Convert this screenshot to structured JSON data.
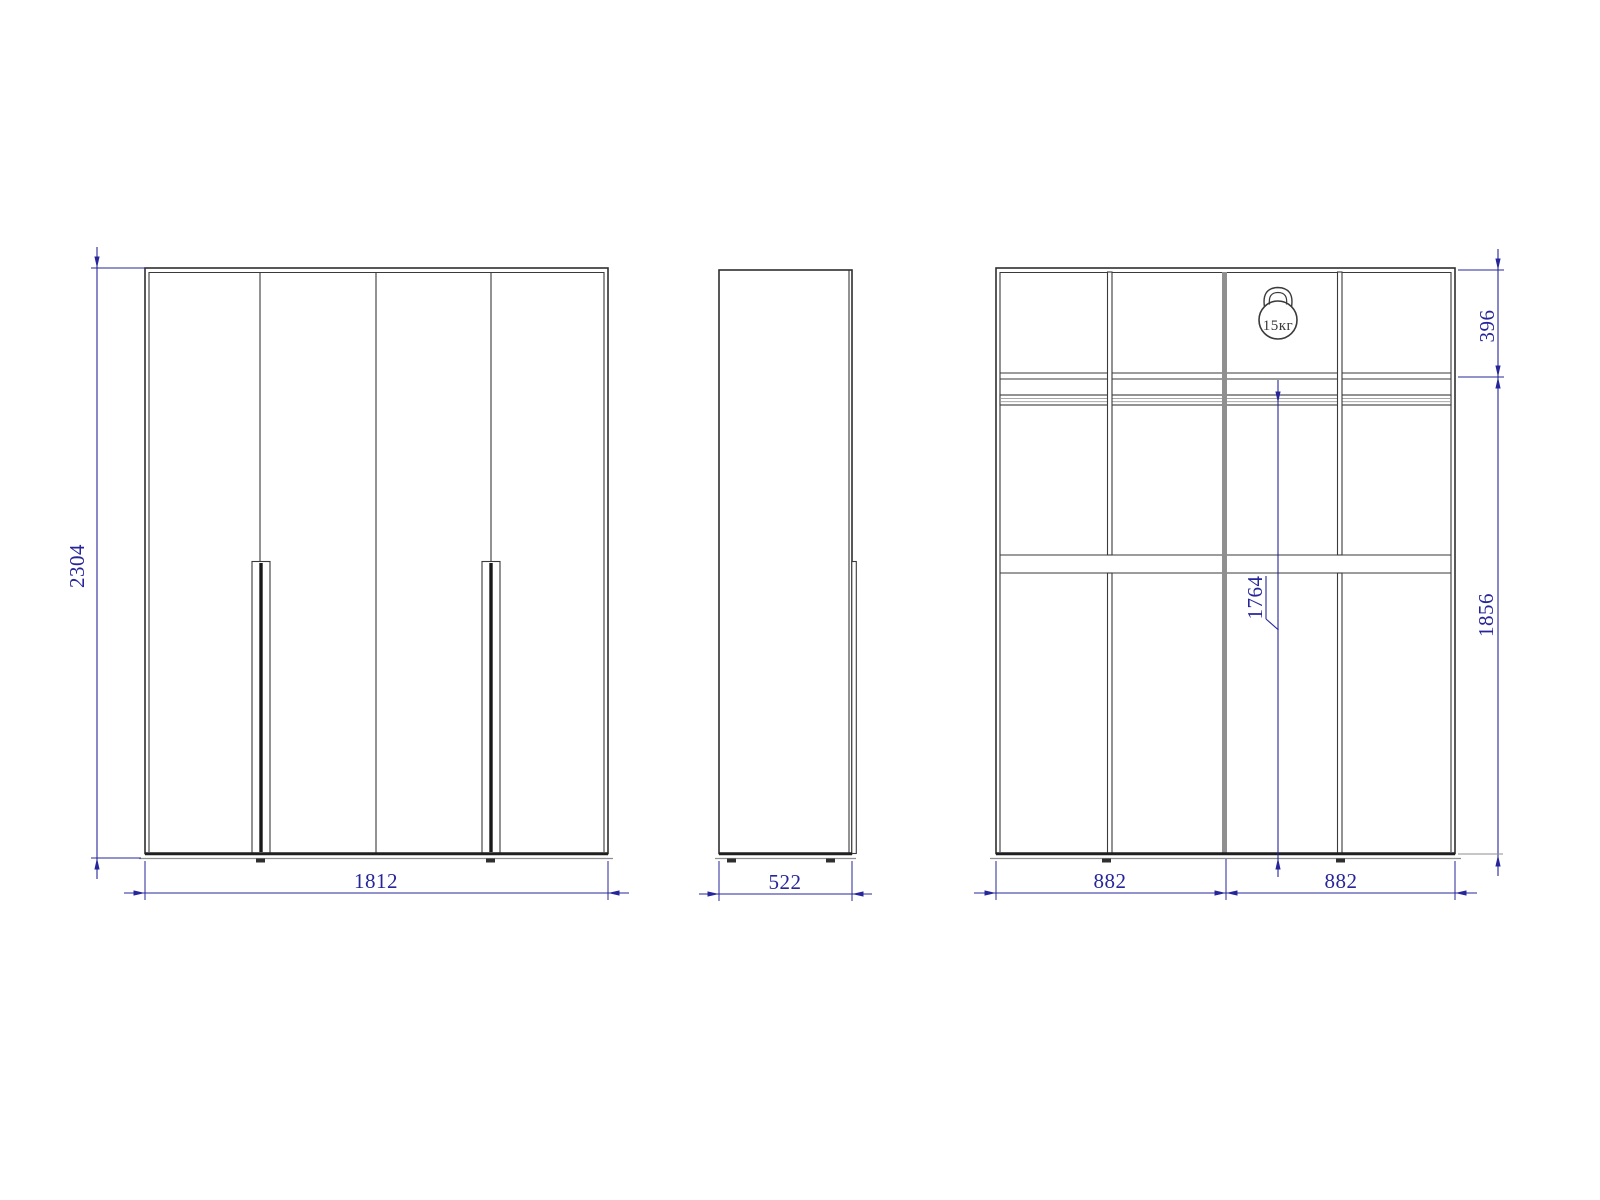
{
  "drawing": {
    "type": "furniture technical drawing, wardrobe, three orthographic views",
    "views": {
      "front": {
        "label": "front-view",
        "doors": 4,
        "handles": 2
      },
      "side": {
        "label": "side-view"
      },
      "internal": {
        "label": "internal-structure-view",
        "sections": 2,
        "shelves": 3,
        "hanging_rod": true
      }
    },
    "dims": {
      "height": "2304",
      "width": "1812",
      "depth": "522",
      "top_section_height": "396",
      "lower_section_height": "1856",
      "rod_height": "1764",
      "left_half_width": "882",
      "right_half_width": "882"
    },
    "load_badge": {
      "text": "15кг",
      "icon": "kettlebell-weight-icon"
    },
    "colors": {
      "background": "#ffffff",
      "outline": "#2f2f2f",
      "thin_line": "#3a3a3a",
      "gray_partition": "#8f8f8f",
      "dimension_blue": "#26269a"
    }
  }
}
